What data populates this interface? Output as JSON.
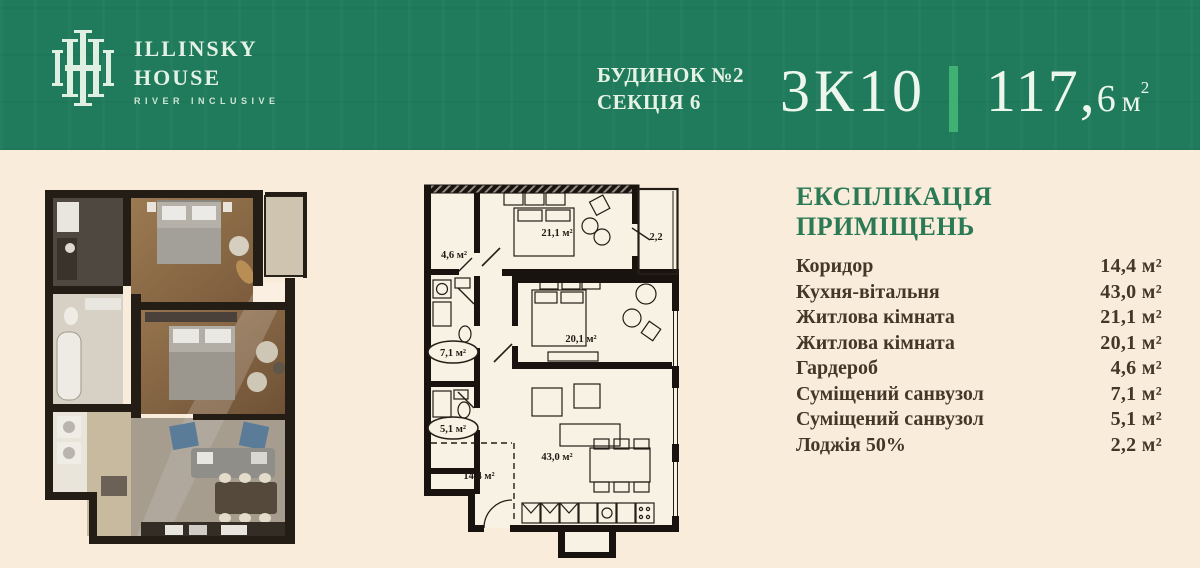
{
  "header": {
    "brand_name_line1": "Illinsky",
    "brand_name_line2": "House",
    "brand_tagline": "River Inclusive",
    "building_line1": "БУДИНОК №2",
    "building_line2": "СЕКЦІЯ 6",
    "unit_code": "3К10",
    "area_whole": "117,",
    "area_fraction": "6",
    "area_unit": "м",
    "area_sup": "2"
  },
  "colors": {
    "header_green": "#1f7b5b",
    "divider_green": "#3eb173",
    "header_text": "#e7f2e6",
    "page_cream": "#f9ecdb",
    "plan_paper": "#f8f2e4",
    "wall_ink": "#18130f",
    "title_green": "#2b7a55",
    "body_ink": "#453728"
  },
  "explication": {
    "title": "ЕКСПЛІКАЦІЯ ПРИМІЩЕНЬ",
    "rows": [
      {
        "label": "Коридор",
        "value": "14,4 м²"
      },
      {
        "label": "Кухня-вітальня",
        "value": "43,0 м²"
      },
      {
        "label": "Житлова кімната",
        "value": "21,1 м²"
      },
      {
        "label": "Житлова кімната",
        "value": "20,1 м²"
      },
      {
        "label": "Гардероб",
        "value": "4,6 м²"
      },
      {
        "label": "Суміщений санвузол",
        "value": "7,1 м²"
      },
      {
        "label": "Суміщений санвузол",
        "value": "5,1 м²"
      },
      {
        "label": "Лоджія 50%",
        "value": "2,2 м²"
      }
    ]
  },
  "plan2d": {
    "labels": {
      "wardrobe": "4,6 м²",
      "bedroom1": "21,1 м²",
      "loggia": "2,2",
      "bedroom2": "20,1 м²",
      "bathroom1": "7,1 м²",
      "bathroom2": "5,1 м²",
      "corridor": "14,4 м²",
      "kitchen_living": "43,0 м²"
    }
  }
}
